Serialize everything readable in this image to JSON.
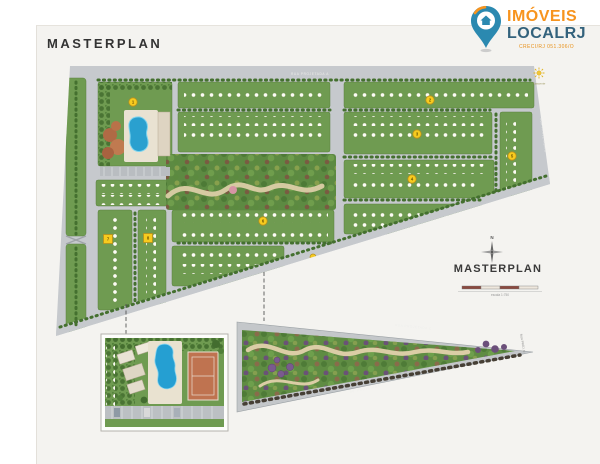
{
  "page": {
    "title": "MASTERPLAN"
  },
  "logo": {
    "brand_top": "IMÓVEIS",
    "brand_bottom": "LOCALRJ",
    "creci": "CRECI/RJ 051.306/O"
  },
  "plan": {
    "label": "MASTERPLAN",
    "compass": "N",
    "sun_label": "Nascente",
    "scale_caption": "escala 1:750",
    "street_top": "RUA PROJETADA A",
    "street_right": "RUA PROJETADA B",
    "annotation": "Nas áreas verdes haverá a implantação de equipamentos de lazer (ver projeto)",
    "markers": [
      "1",
      "2",
      "3",
      "4",
      "5",
      "6",
      "7",
      "8"
    ]
  },
  "insets": {
    "park": {
      "street_top": "RUA PROJETADA C",
      "street_bottom": "AV. PROJETADA",
      "street_right": "RUA PROJ. D"
    }
  },
  "colors": {
    "accent_orange": "#f7941e",
    "brand_blue": "#33627c",
    "block_green": "#6f9b51",
    "road_gray": "#c6c9cd",
    "pool_blue": "#2aa0cf",
    "marker_yellow": "#f7cb1f"
  }
}
